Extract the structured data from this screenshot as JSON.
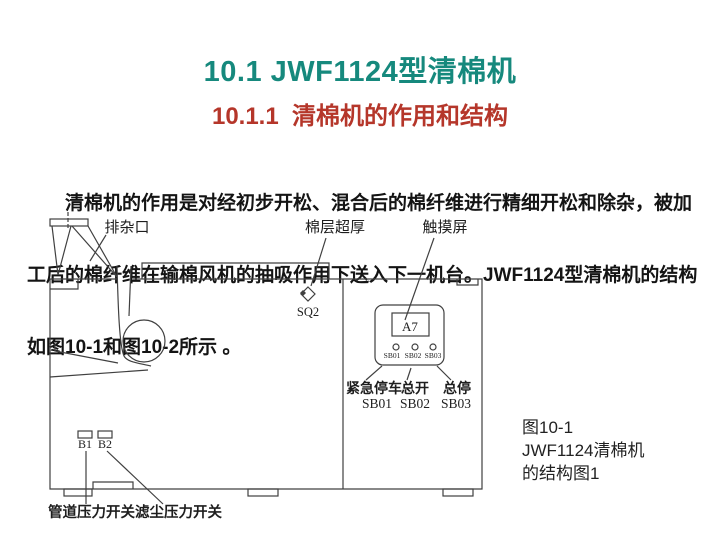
{
  "header": {
    "title": "10.1 JWF1124型清棉机",
    "subtitle": "10.1.1  清棉机的作用和结构",
    "title_color": "#16897d",
    "subtitle_color": "#b5362a"
  },
  "body": {
    "lines": [
      "　　清棉机的作用是对经初步开松、混合后的棉纤维进行精细开松和除杂，被加",
      "工后的棉纤维在输棉风机的抽吸作用下送入下一机台。JWF1124型清棉机的结构",
      "如图10-1和图10-2所示 。"
    ]
  },
  "diagram": {
    "line_color": "#404040",
    "labels": {
      "waste_port": "排杂口",
      "cotton_layer_thick": "棉层超厚",
      "touch_screen": "触摸屏",
      "sq2": "SQ2",
      "a7": "A7",
      "sb01_small": "SB01",
      "sb02_small": "SB02",
      "sb03_small": "SB03",
      "emergency_stop": "紧急停车",
      "emergency_stop_code": "SB01",
      "main_on": "总开",
      "main_on_code": "SB02",
      "main_stop": "总停",
      "main_stop_code": "SB03",
      "b1": "B1",
      "b2": "B2",
      "pipe_pressure_switch": "管道压力开关",
      "dust_pressure_switch": "滤尘压力开关"
    }
  },
  "figure": {
    "caption_lines": [
      "图10-1",
      "JWF1124清棉机",
      "的结构图1"
    ]
  }
}
